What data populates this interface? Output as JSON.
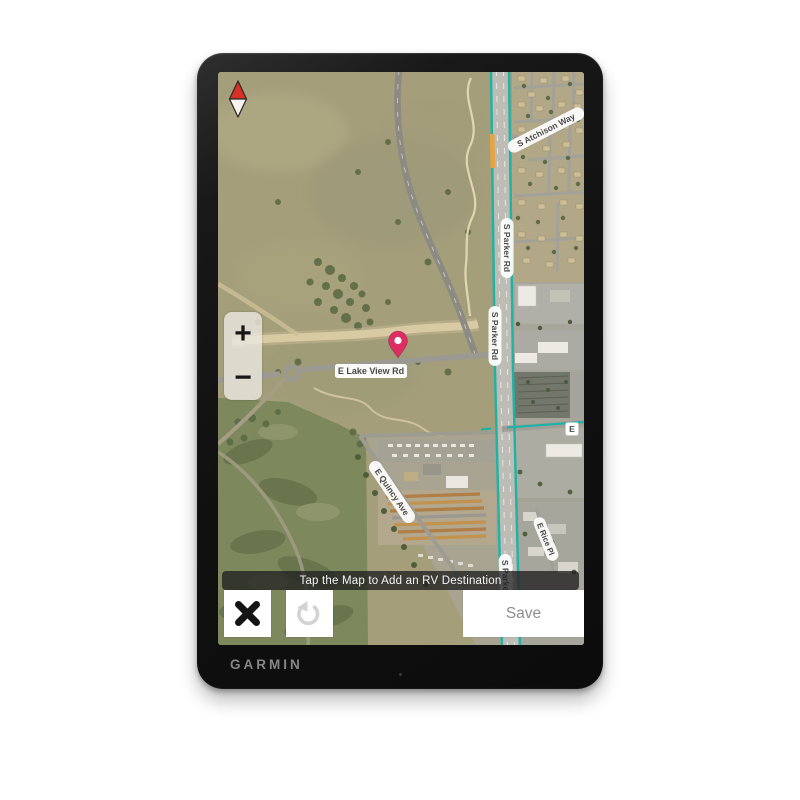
{
  "device": {
    "brand": "GARMIN"
  },
  "map": {
    "labels": {
      "atchison": "S Atchison Way",
      "parker": "S Parker Rd",
      "lakeview": "E Lake View Rd",
      "quincy": "E Quincy Ave",
      "rice": "E Rice Pl",
      "east_abbrev": "E"
    },
    "colors": {
      "traffic_free": "#1fb2a6",
      "traffic_slow": "#e8a33d",
      "pin": "#dd2e63",
      "compass_north": "#d93025"
    }
  },
  "controls": {
    "zoom_in": "+",
    "zoom_out": "−"
  },
  "toast": {
    "message": "Tap the Map to Add an RV Destination"
  },
  "actions": {
    "save": "Save"
  }
}
